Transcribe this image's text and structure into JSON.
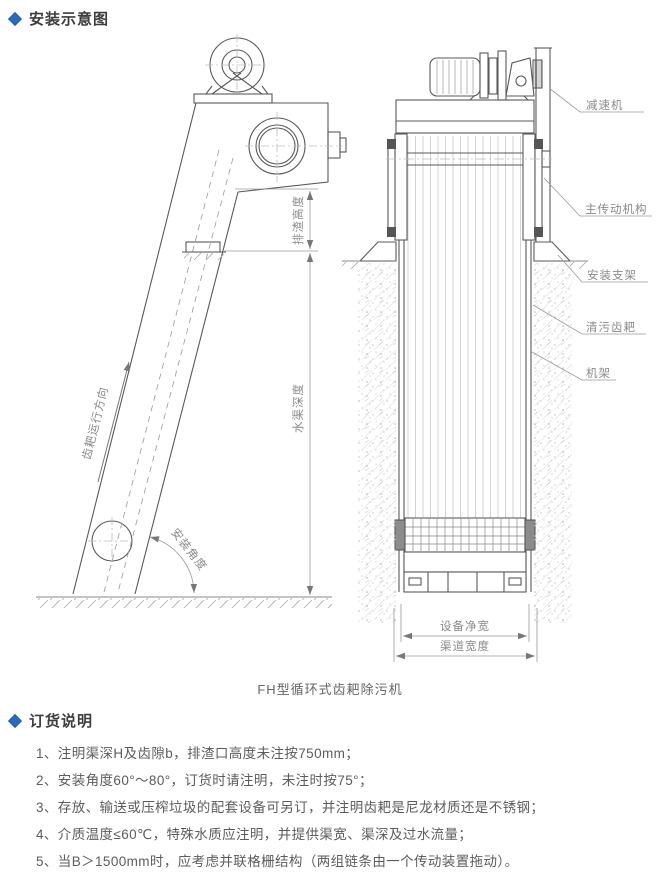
{
  "colors": {
    "accent_blue": "#2b6bbf",
    "drawing_line": "#5a5a5a",
    "dimension_line": "#9a9a9a",
    "body_text": "#5c5c5c",
    "label_text": "#8a8a8a"
  },
  "sections": {
    "install": {
      "title": "安装示意图"
    },
    "order": {
      "title": "订货说明"
    }
  },
  "diagram": {
    "caption": "FH型循环式齿耙除污机",
    "part_labels": [
      "减速机",
      "主传动机构",
      "安装支架",
      "清污齿耙",
      "机架"
    ],
    "dimension_labels": {
      "discharge_height": "排渣高度",
      "channel_depth": "水渠深度",
      "equipment_net_width": "设备净宽",
      "channel_width": "渠道宽度"
    },
    "annotations": {
      "rake_direction": "齿耙运行方向",
      "install_angle": "安装角度"
    }
  },
  "order_notes": {
    "items": [
      "1、注明渠深H及齿隙b，排渣口高度未注按750mm；",
      "2、安装角度60°～80°，订货时请注明，未注时按75°；",
      "3、存放、输送或压榨垃圾的配套设备可另订，并注明齿耙是尼龙材质还是不锈钢；",
      "4、介质温度≤60℃，特殊水质应注明，并提供渠宽、渠深及过水流量；",
      "5、当B＞1500mm时，应考虑并联格栅结构（两组链条由一个传动装置拖动）。"
    ]
  }
}
